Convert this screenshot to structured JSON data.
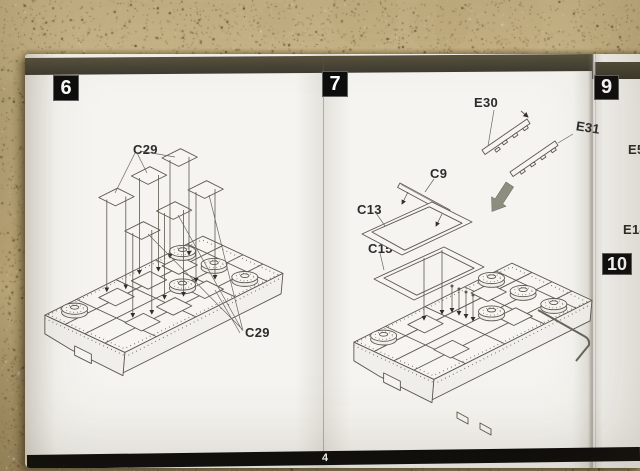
{
  "scene": {
    "description": "Photo of an open model-kit instruction booklet on a speckled countertop",
    "page_number": "4"
  },
  "colors": {
    "countertop_base": "#c9b583",
    "countertop_speckle_dark": "#4e3c22",
    "countertop_speckle_mid": "#8a6d42",
    "countertop_speckle_light": "#e8ddbf",
    "paper": "#f5f4f0",
    "header_band": "#4b473c",
    "footer_band": "#0c0c0c",
    "step_box_bg": "#0e0e0e",
    "step_box_text": "#ffffff",
    "line_art": "#5d5850",
    "label_text": "#2b2b2b",
    "assembly_arrow": "#8e8e80"
  },
  "steps": {
    "step6": {
      "number": "6"
    },
    "step7": {
      "number": "7"
    },
    "step9": {
      "number": "9"
    },
    "step10": {
      "number": "10"
    }
  },
  "labels": {
    "c29_top": "C29",
    "c29_bottom": "C29",
    "e30": "E30",
    "e31": "E31",
    "c9": "C9",
    "c13": "C13",
    "c15": "C15",
    "e5": "E5",
    "e14": "E14"
  },
  "footer": {
    "page_number": "4"
  }
}
